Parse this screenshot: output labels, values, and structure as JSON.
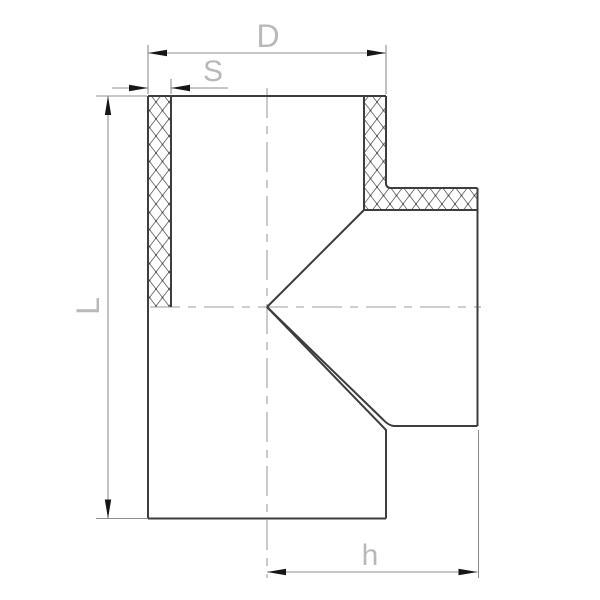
{
  "drawing": {
    "kind": "tee-fitting-section-drawing",
    "labels": {
      "d": "D",
      "s": "S",
      "l": "L",
      "h": "h"
    }
  },
  "colors": {
    "background": "#ffffff",
    "outline": "#3d3d3d",
    "hatch_line": "#6e6e6e",
    "hatch_dot": "#4a4a4a",
    "dimension_line": "#8f8f8f",
    "centerline": "#9e9e9e",
    "arrowhead": "#161616",
    "label": "#b9b9b9"
  }
}
